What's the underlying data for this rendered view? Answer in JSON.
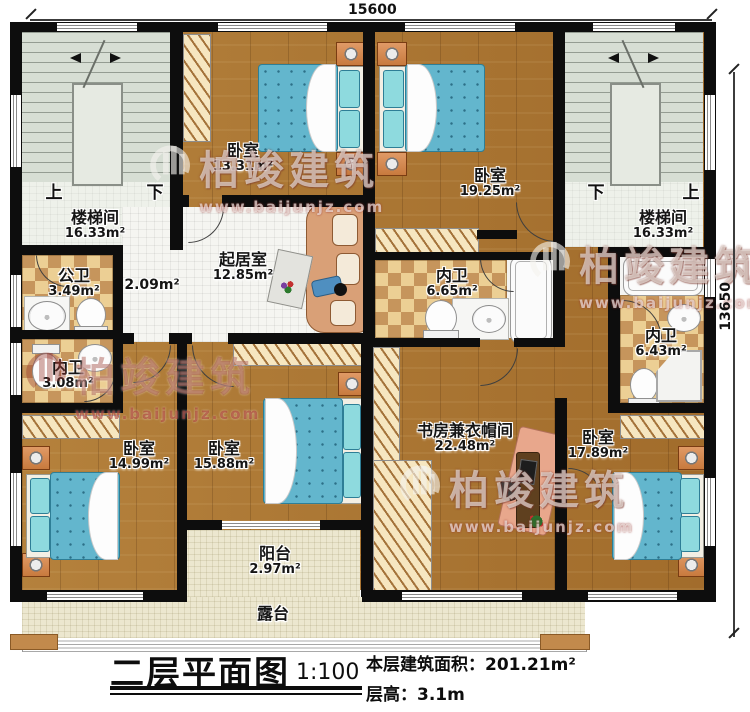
{
  "plan": {
    "dimensions": {
      "top": "15600",
      "right": "13650"
    },
    "title": {
      "text": "二层平面图",
      "scale": "1:100",
      "area_label": "本层建筑面积：",
      "area_value": "201.21m²",
      "floor_height_label": "层高：",
      "floor_height_value": "3.1m"
    }
  },
  "rooms": [
    {
      "name": "楼梯间",
      "area": "16.33m²"
    },
    {
      "name": "卧室",
      "area": "13.31m²"
    },
    {
      "name": "卧室",
      "area": "19.25m²"
    },
    {
      "name": "楼梯间",
      "area": "16.33m²"
    },
    {
      "name": "公卫",
      "area": "3.49m²"
    },
    {
      "name": "",
      "area": "2.09m²"
    },
    {
      "name": "起居室",
      "area": "12.85m²"
    },
    {
      "name": "内卫",
      "area": "6.65m²"
    },
    {
      "name": "内卫",
      "area": "3.08m²"
    },
    {
      "name": "内卫",
      "area": "6.43m²"
    },
    {
      "name": "卧室",
      "area": "14.99m²"
    },
    {
      "name": "卧室",
      "area": "15.88m²"
    },
    {
      "name": "书房兼衣帽间",
      "area": "22.48m²"
    },
    {
      "name": "卧室",
      "area": "17.89m²"
    },
    {
      "name": "阳台",
      "area": "2.97m²"
    },
    {
      "name": "露台",
      "area": ""
    }
  ],
  "stairs": {
    "left_up": "上",
    "left_down": "下",
    "right_down": "下",
    "right_up": "上"
  },
  "watermark": {
    "brand": "柏竣建筑",
    "url": "www.baijunjz.com"
  }
}
